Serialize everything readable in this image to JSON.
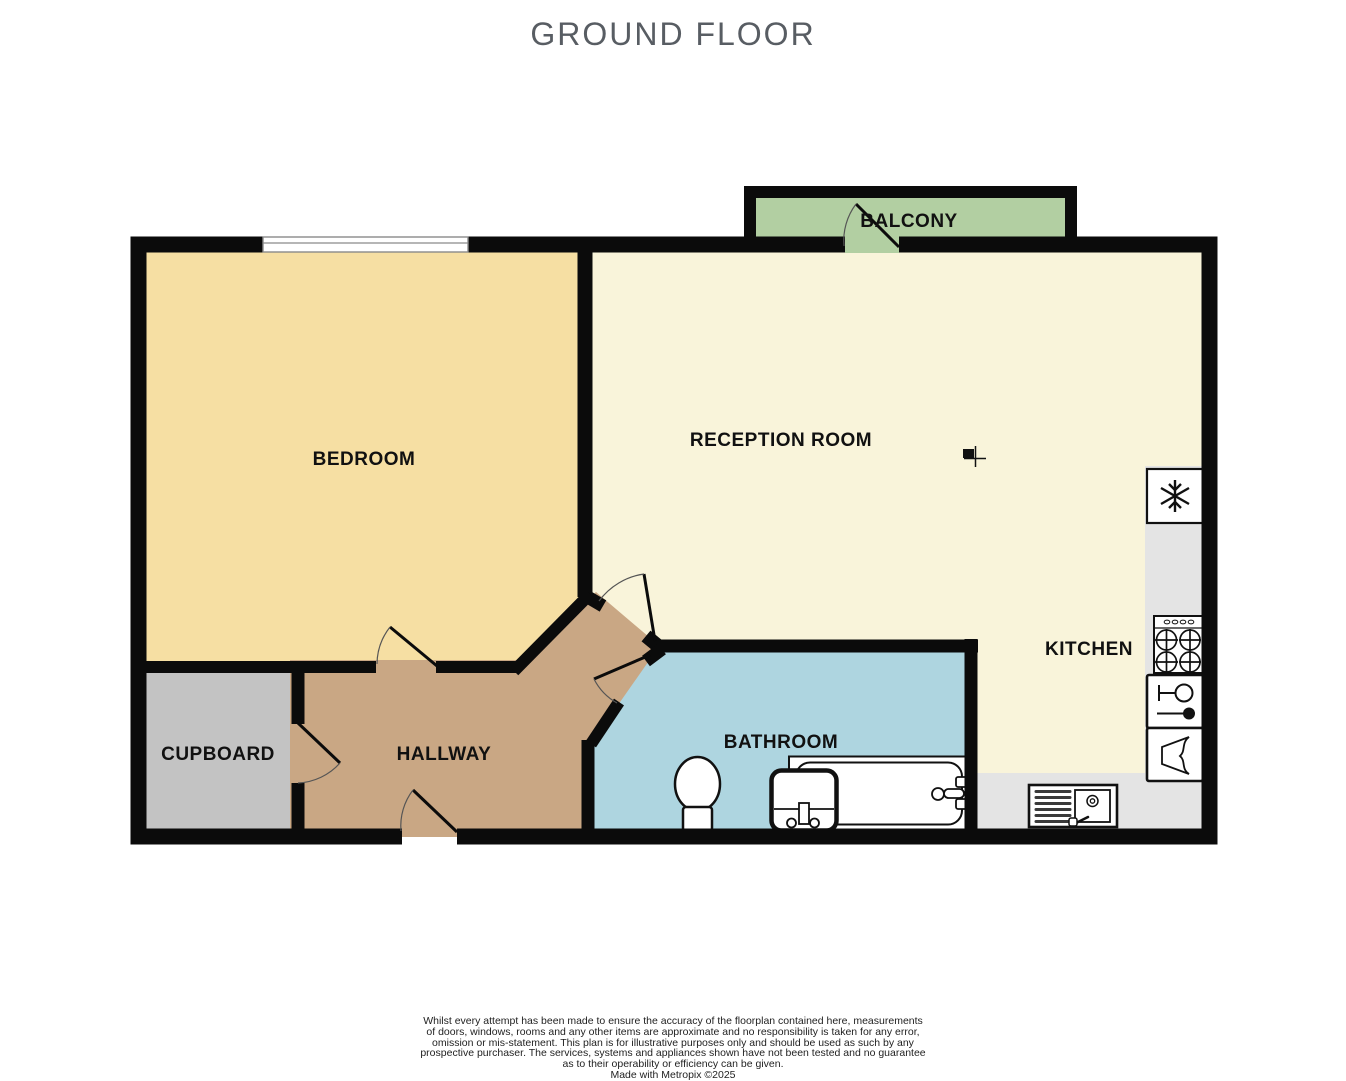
{
  "page": {
    "title": "GROUND FLOOR"
  },
  "rooms": {
    "balcony": {
      "label": "BALCONY"
    },
    "bedroom": {
      "label": "BEDROOM"
    },
    "reception": {
      "label": "RECEPTION ROOM"
    },
    "kitchen": {
      "label": "KITCHEN"
    },
    "cupboard": {
      "label": "CUPBOARD"
    },
    "hallway": {
      "label": "HALLWAY"
    },
    "bathroom": {
      "label": "BATHROOM"
    }
  },
  "colors": {
    "wall": "#0b0b0b",
    "balcony": "#b2cfa2",
    "bedroom": "#f6dfa3",
    "reception": "#f9f4da",
    "hallway": "#c9a784",
    "bathroom": "#aed5e0",
    "cupboard": "#c3c3c3",
    "counter": "#e4e4e4",
    "window": "#ffffff",
    "title_text": "#585d63",
    "label_text": "#111111"
  },
  "icons": {
    "fridge": "snowflake-icon",
    "hob": "four-burner-hob-icon",
    "dishwasher": "wine-glass-plate-icon",
    "washing_machine": "washer-drum-icon",
    "sink": "sink-drainer-icon",
    "toilet": "toilet-icon",
    "basin": "basin-icon",
    "bath": "bathtub-icon",
    "cursor": "cursor-icon"
  },
  "disclaimer": {
    "lines": [
      "Whilst every attempt has been made to ensure the accuracy of the floorplan contained here, measurements",
      "of doors, windows, rooms and any other items are approximate and no responsibility is taken for any error,",
      "omission or mis-statement. This plan is for illustrative purposes only and should be used as such by any",
      "prospective purchaser. The services, systems and appliances shown have not been tested and no guarantee",
      "as to their operability or efficiency can be given."
    ],
    "credit": "Made with Metropix ©2025"
  }
}
